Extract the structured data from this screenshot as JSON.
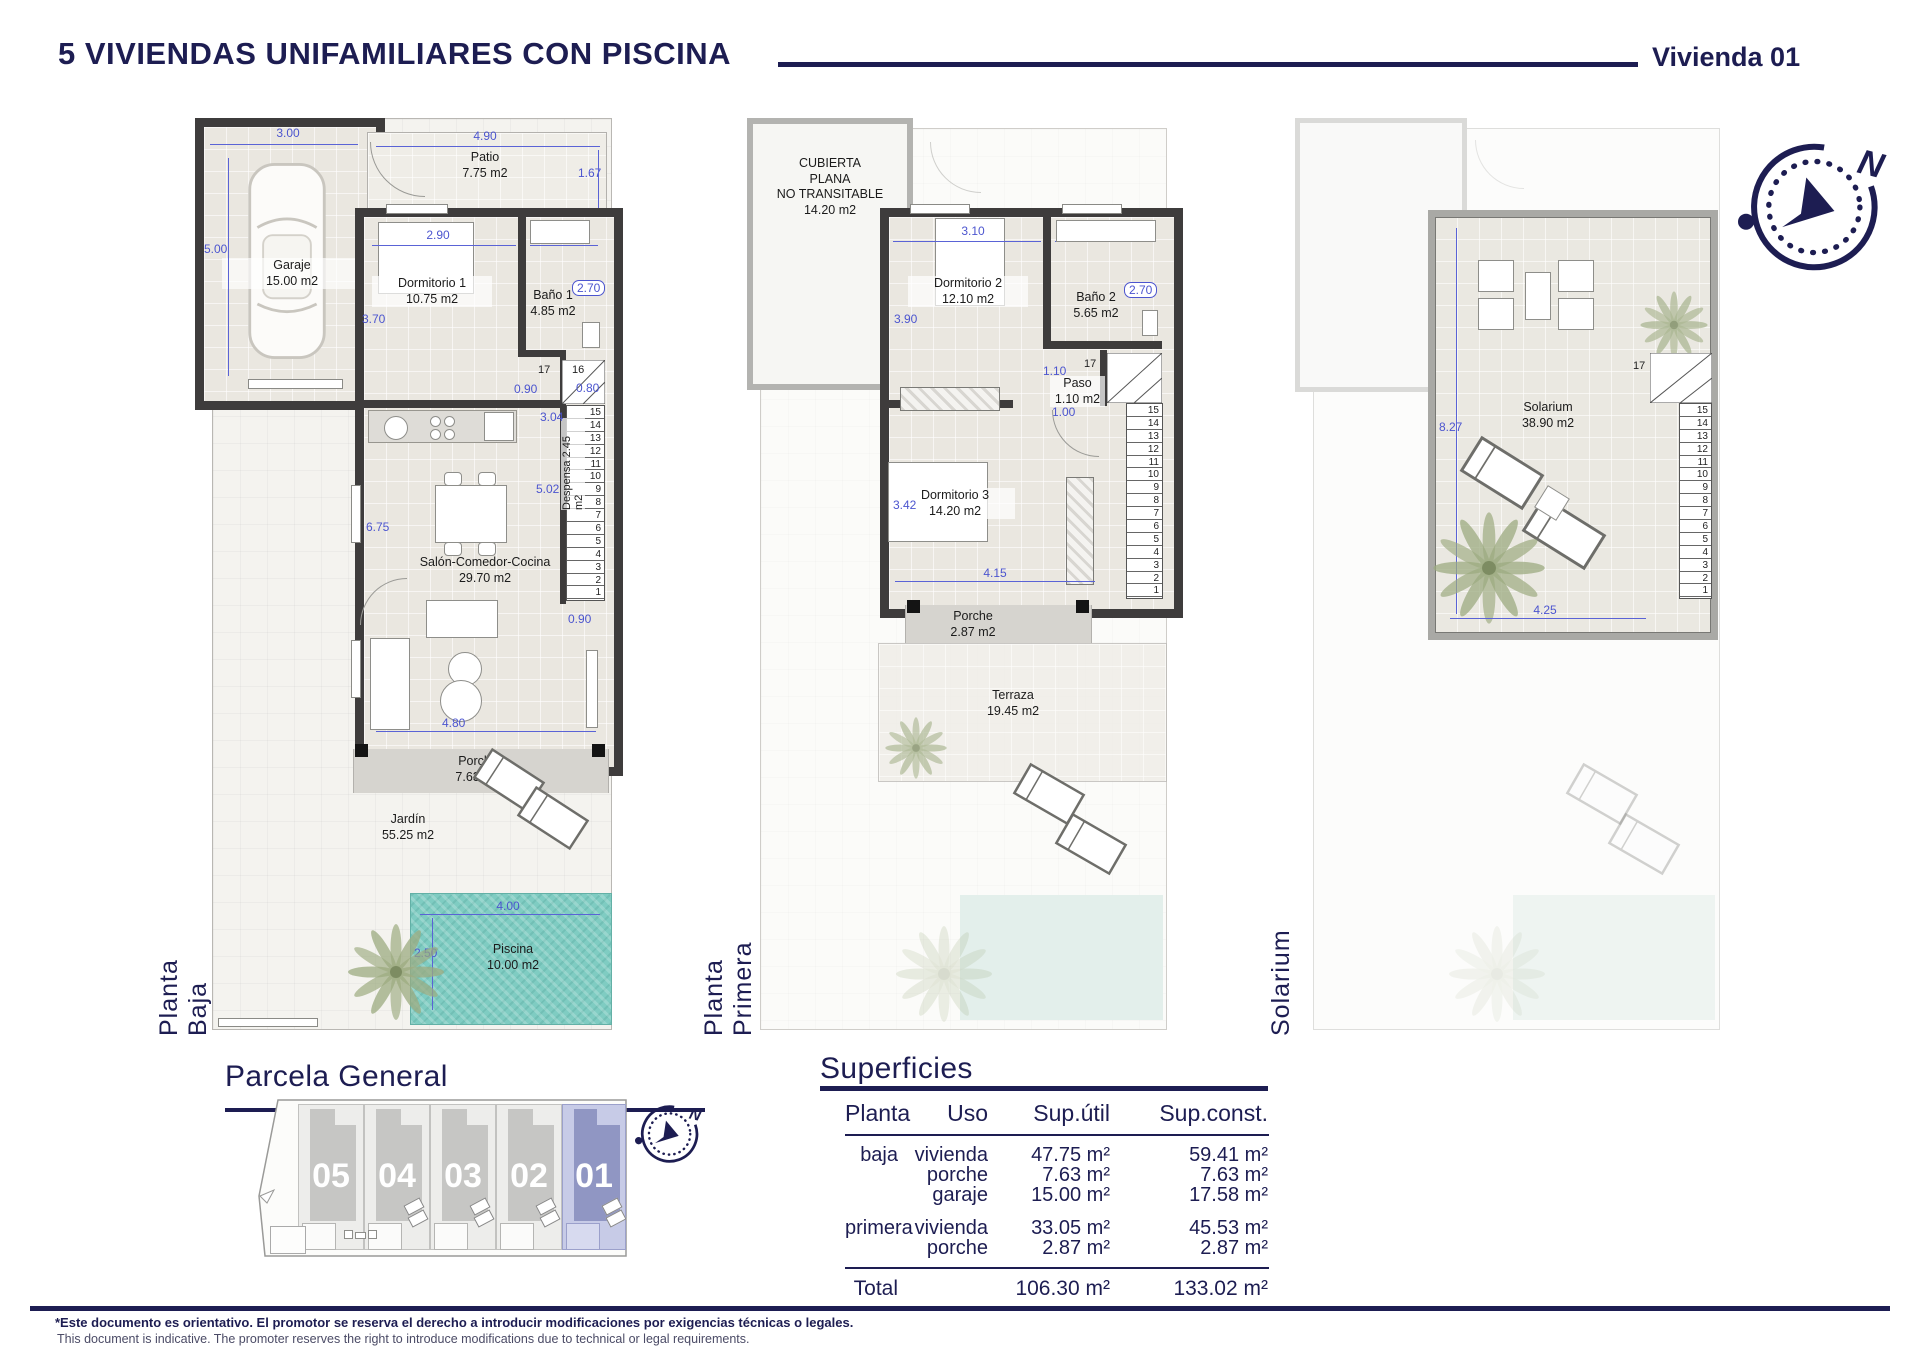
{
  "header": {
    "title": "5 VIVIENDAS UNIFAMILIARES CON PISCINA",
    "unit": "Vivienda 01"
  },
  "compass": {
    "north_label": "N"
  },
  "plans": {
    "baja": {
      "label": "Planta Baja",
      "rooms": {
        "garaje": {
          "name": "Garaje",
          "area": "15.00 m2"
        },
        "patio": {
          "name": "Patio",
          "area": "7.75 m2"
        },
        "dormitorio1": {
          "name": "Dormitorio 1",
          "area": "10.75 m2"
        },
        "bano1": {
          "name": "Baño 1",
          "area": "4.85 m2"
        },
        "despensa": {
          "name": "Despensa",
          "area": "2.45 m2"
        },
        "salon": {
          "name": "Salón-Comedor-Cocina",
          "area": "29.70 m2"
        },
        "porche": {
          "name": "Porche",
          "area": "7.63 m2"
        },
        "jardin": {
          "name": "Jardín",
          "area": "55.25 m2"
        },
        "piscina": {
          "name": "Piscina",
          "area": "10.00 m2"
        }
      },
      "dims": {
        "garaje_w": "3.00",
        "patio_w": "4.90",
        "patio_h": "1.67",
        "garaje_h": "5.00",
        "dorm1_w": "2.90",
        "bano1_w": "1.80",
        "dorm1_h": "3.70",
        "bano1_h": "2.70",
        "paso_l": "0.90",
        "paso_r": "0.80",
        "despensa_h": "3.04",
        "salon_h": "5.02",
        "salon_h2": "6.75",
        "stair_w": "0.90",
        "salon_w": "4.80",
        "piscina_w": "4.00",
        "piscina_h": "2.50",
        "step17": "17",
        "step16": "16"
      },
      "stairs": [
        "15",
        "14",
        "13",
        "12",
        "11",
        "10",
        "9",
        "8",
        "7",
        "6",
        "5",
        "4",
        "3",
        "2",
        "1"
      ]
    },
    "primera": {
      "label": "Planta Primera",
      "rooms": {
        "cubierta": {
          "l1": "CUBIERTA",
          "l2": "PLANA",
          "l3": "NO TRANSITABLE",
          "area": "14.20 m2"
        },
        "dormitorio2": {
          "name": "Dormitorio 2",
          "area": "12.10 m2"
        },
        "bano2": {
          "name": "Baño 2",
          "area": "5.65 m2"
        },
        "paso": {
          "name": "Paso",
          "area": "1.10 m2"
        },
        "dormitorio3": {
          "name": "Dormitorio 3",
          "area": "14.20 m2"
        },
        "porche": {
          "name": "Porche",
          "area": "2.87 m2"
        },
        "terraza": {
          "name": "Terraza",
          "area": "19.45 m2"
        }
      },
      "dims": {
        "dorm2_w": "3.10",
        "bano2_w": "2.10",
        "dorm2_h": "3.90",
        "bano2_h": "2.70",
        "paso_w": "1.10",
        "paso_w2": "1.00",
        "dorm3_h": "3.42",
        "dorm3_w": "4.15",
        "step17": "17",
        "step16": "16"
      },
      "stairs": [
        "15",
        "14",
        "13",
        "12",
        "11",
        "10",
        "9",
        "8",
        "7",
        "6",
        "5",
        "4",
        "3",
        "2",
        "1"
      ]
    },
    "solarium": {
      "label": "Solarium",
      "rooms": {
        "solarium": {
          "name": "Solarium",
          "area": "38.90 m2"
        }
      },
      "dims": {
        "h": "8.27",
        "w": "4.25",
        "step17": "17",
        "step16": "16"
      },
      "stairs": [
        "15",
        "14",
        "13",
        "12",
        "11",
        "10",
        "9",
        "8",
        "7",
        "6",
        "5",
        "4",
        "3",
        "2",
        "1"
      ]
    }
  },
  "parcela": {
    "heading": "Parcela General",
    "units": [
      {
        "num": "05"
      },
      {
        "num": "04"
      },
      {
        "num": "03"
      },
      {
        "num": "02"
      },
      {
        "num": "01"
      }
    ]
  },
  "superficies": {
    "heading": "Superficies",
    "columns": [
      "Planta",
      "Uso",
      "Sup.útil",
      "Sup.const."
    ],
    "rows": [
      {
        "planta": "baja",
        "uso": "vivienda",
        "util": "47.75 m²",
        "cons": "59.41 m²"
      },
      {
        "planta": "",
        "uso": "porche",
        "util": "7.63 m²",
        "cons": "7.63 m²"
      },
      {
        "planta": "",
        "uso": "garaje",
        "util": "15.00 m²",
        "cons": "17.58 m²"
      },
      {
        "planta": "primera",
        "uso": "vivienda",
        "util": "33.05 m²",
        "cons": "45.53 m²"
      },
      {
        "planta": "",
        "uso": "porche",
        "util": "2.87 m²",
        "cons": "2.87 m²"
      }
    ],
    "total": {
      "label": "Total",
      "util": "106.30 m²",
      "cons": "133.02 m²"
    }
  },
  "footer": {
    "es": "*Este documento es orientativo. El promotor se reserva el derecho a introducir modificaciones por exigencias técnicas o legales.",
    "en": "This document is indicative. The promoter reserves the right to introduce modifications due to technical or legal requirements."
  }
}
